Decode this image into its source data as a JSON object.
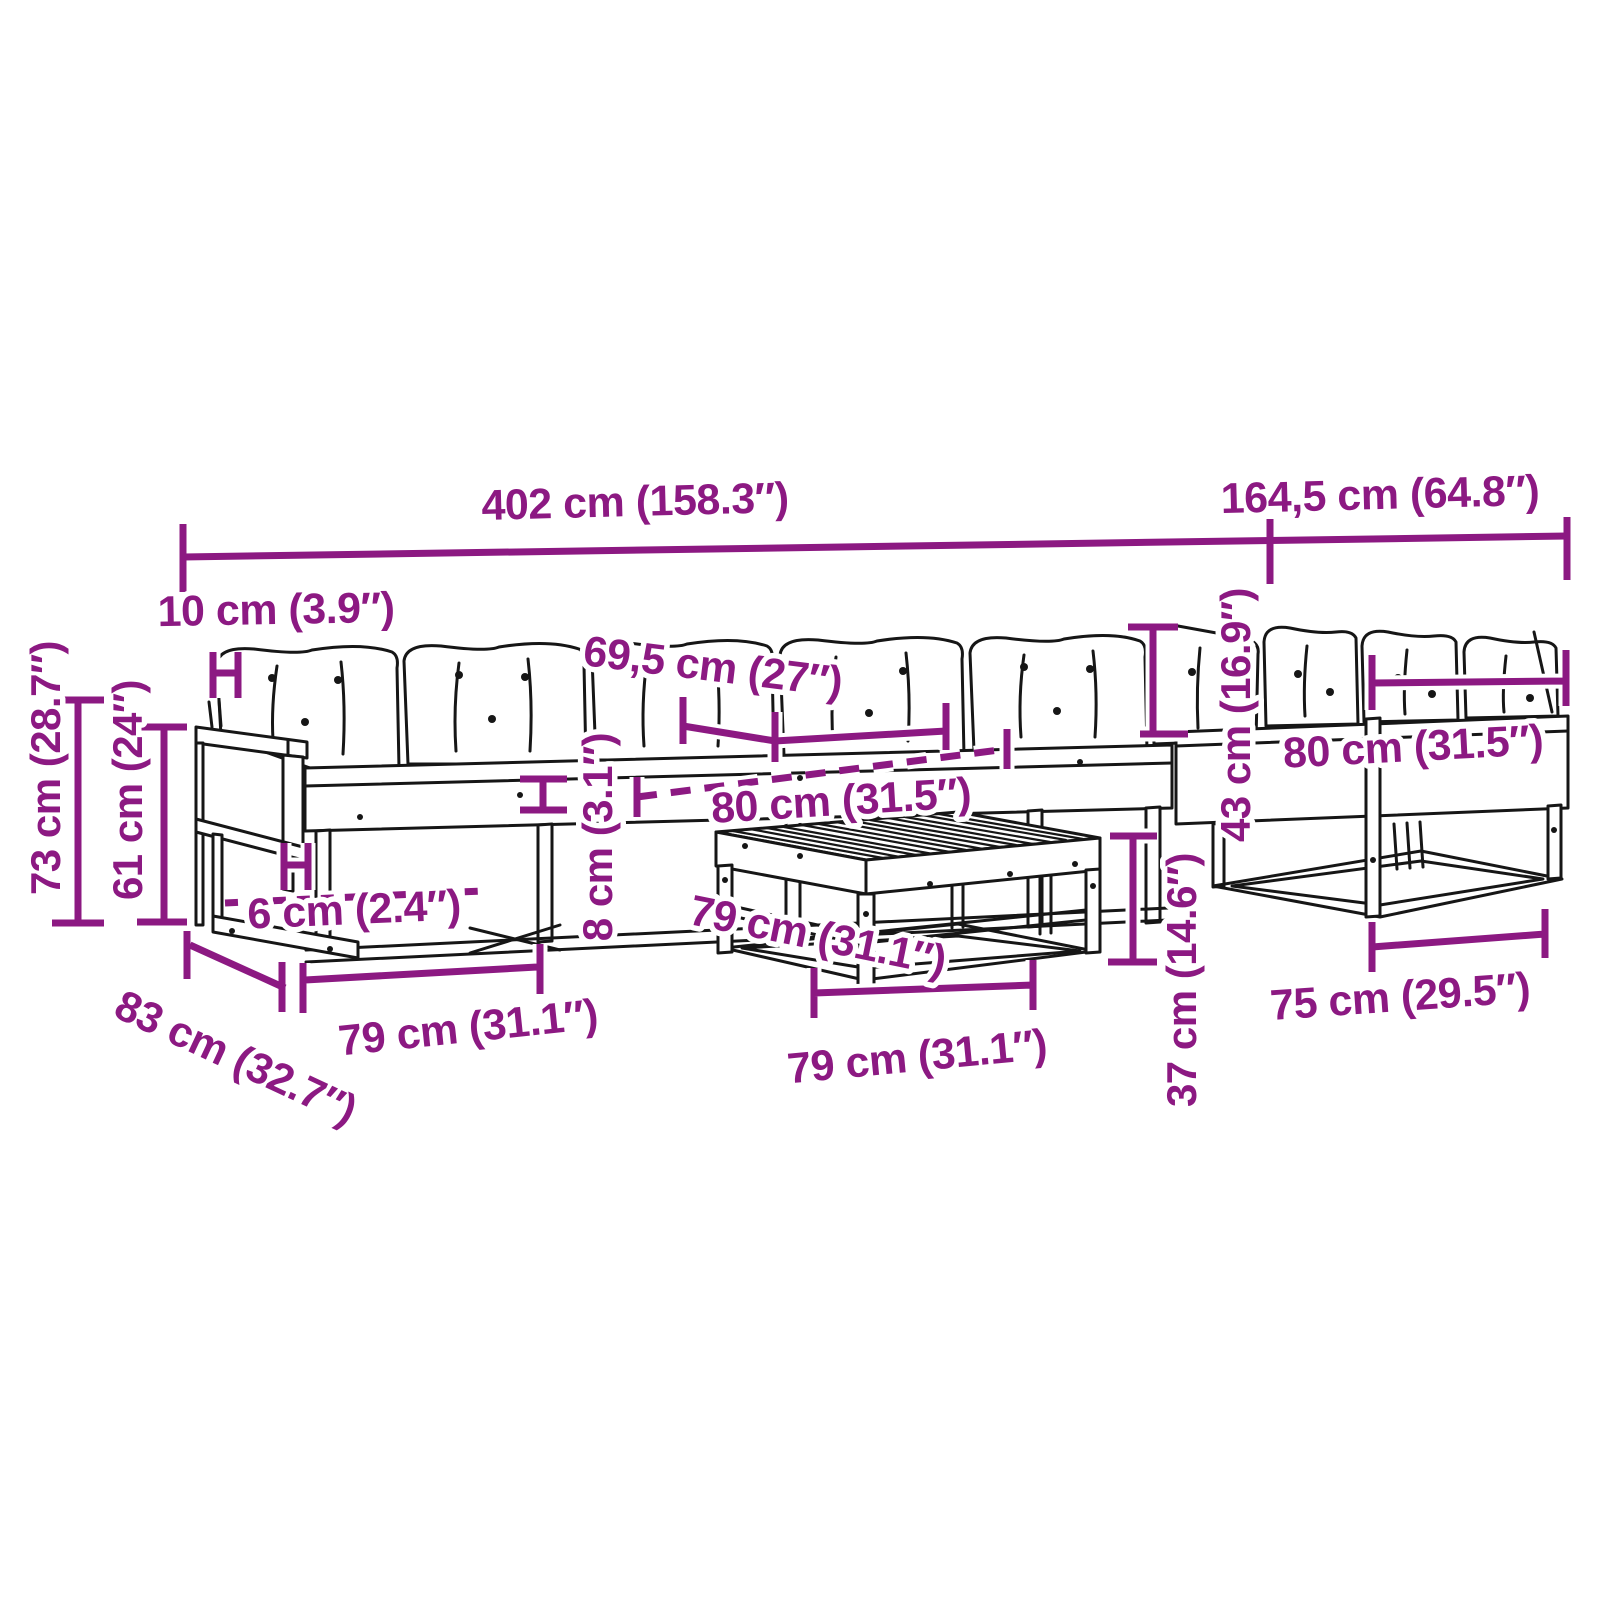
{
  "colors": {
    "dimension": "#8C1982",
    "line_art": "#161616",
    "background": "#FFFFFF"
  },
  "dims": {
    "overall_length": "402 cm (158.3″)",
    "right_section_length": "164,5 cm (64.8″)",
    "armrest_width": "10 cm (3.9″)",
    "back_cushion_width": "69,5 cm (27″)",
    "seat_depth": "80 cm (31.5″)",
    "right_seat_width": "80 cm (31.5″)",
    "backrest_height": "43 cm (16.9″)",
    "total_height": "73 cm (28.7″)",
    "armrest_height": "61 cm (24″)",
    "board_thickness": "6 cm (2.4″)",
    "seat_thickness": "8 cm (3.1″)",
    "table_depth": "79 cm (31.1″)",
    "module_width": "79 cm (31.1″)",
    "table_width": "79 cm (31.1″)",
    "module_depth": "83 cm (32.7″)",
    "seat_height": "37 cm (14.6″)",
    "bench_width": "75 cm (29.5″)"
  }
}
